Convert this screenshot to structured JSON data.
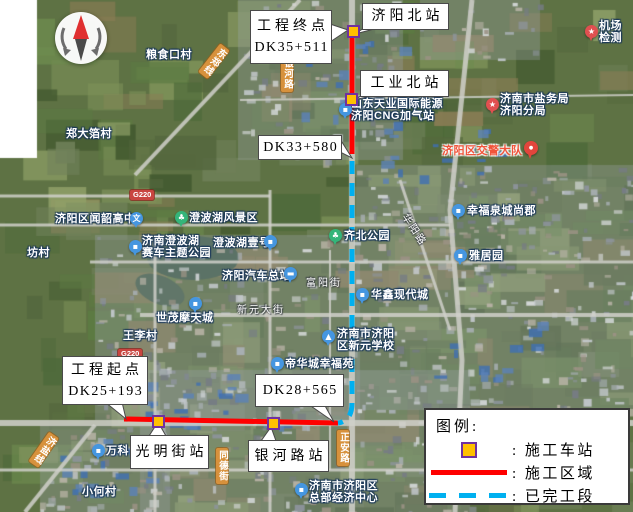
{
  "legend": {
    "title": "图例:",
    "items": [
      {
        "swatch": "station",
        "label": ": 施工车站"
      },
      {
        "swatch": "solid",
        "label": ": 施工区域"
      },
      {
        "swatch": "dashed",
        "label": ": 已完工段"
      }
    ],
    "colors": {
      "station_fill": "#FFC000",
      "station_border": "#7030A0",
      "solid": "#FF0000",
      "dashed": "#00B0F0"
    }
  },
  "route": {
    "solid_color": "#FF0000",
    "dashed_color": "#00B0F0",
    "solid_paths": [
      "M352 26 L352 154",
      "M124 419 L338 423"
    ],
    "dashed_paths": [
      "M352 161 L352 403 Q352 421 338 423"
    ]
  },
  "stations": [
    {
      "name": "station-marker-jiyang-north",
      "x": 353,
      "y": 31
    },
    {
      "name": "station-marker-gongye-north",
      "x": 351,
      "y": 99
    },
    {
      "name": "station-marker-guangming-street",
      "x": 158,
      "y": 421
    },
    {
      "name": "station-marker-yinhe-road",
      "x": 273,
      "y": 423
    }
  ],
  "callouts": [
    {
      "name": "callout-project-end",
      "lines": [
        "工程终点",
        "DK35+511"
      ],
      "box": [
        250,
        10,
        80,
        52
      ],
      "tri": [
        [
          330,
          24
        ],
        [
          330,
          42
        ],
        [
          348,
          30
        ]
      ]
    },
    {
      "name": "callout-jiyang-north-station",
      "lines": [
        "济阳北站"
      ],
      "box": [
        362,
        3,
        85,
        25
      ],
      "tri": [
        [
          364,
          28
        ],
        [
          378,
          28
        ],
        [
          355,
          34
        ]
      ]
    },
    {
      "name": "callout-gongye-north-station",
      "lines": [
        "工业北站"
      ],
      "box": [
        360,
        70,
        87,
        25
      ],
      "tri": [
        [
          363,
          95
        ],
        [
          377,
          95
        ],
        [
          353,
          100
        ]
      ]
    },
    {
      "name": "callout-dk33",
      "lines": [
        "DK33+580"
      ],
      "box": [
        258,
        135,
        82,
        23
      ],
      "tri": [
        [
          340,
          139
        ],
        [
          340,
          152
        ],
        [
          352,
          158
        ]
      ]
    },
    {
      "name": "callout-project-start",
      "lines": [
        "工程起点",
        "DK25+193"
      ],
      "box": [
        62,
        356,
        84,
        47
      ],
      "tri": [
        [
          105,
          402
        ],
        [
          122,
          402
        ],
        [
          126,
          419
        ]
      ]
    },
    {
      "name": "callout-dk28",
      "lines": [
        "DK28+565"
      ],
      "box": [
        255,
        374,
        87,
        31
      ],
      "tri": [
        [
          308,
          404
        ],
        [
          324,
          404
        ],
        [
          334,
          422
        ]
      ]
    },
    {
      "name": "callout-guangming-street-station",
      "lines": [
        "光明街站"
      ],
      "box": [
        130,
        435,
        77,
        32
      ],
      "tri": [
        [
          149,
          436
        ],
        [
          166,
          436
        ],
        [
          158,
          422
        ]
      ]
    },
    {
      "name": "callout-yinhe-road-station",
      "lines": [
        "银河路站"
      ],
      "box": [
        248,
        440,
        79,
        30
      ],
      "tri": [
        [
          261,
          441
        ],
        [
          276,
          441
        ],
        [
          271,
          427
        ]
      ]
    }
  ],
  "map_labels": [
    {
      "name": "poi-liangshikou-village",
      "text": "粮食口村",
      "x": 146,
      "y": 49
    },
    {
      "name": "poi-zhengdabo-village",
      "text": "郑大箔村",
      "x": 66,
      "y": 128
    },
    {
      "name": "poi-fang-village",
      "text": "坊村",
      "x": 27,
      "y": 247
    },
    {
      "name": "poi-cng-station",
      "lines": [
        "山东天业国际能源",
        "济阳CNG加气站"
      ],
      "x": 351,
      "y": 98,
      "icon": "building",
      "ix": 339,
      "iy": 103
    },
    {
      "name": "poi-airport-checkpoint",
      "lines": [
        "机场",
        "检测"
      ],
      "x": 599,
      "y": 20,
      "icon": "star",
      "ix": 585,
      "iy": 25
    },
    {
      "name": "poi-salt-bureau",
      "lines": [
        "济南市盐务局",
        "济阳分局"
      ],
      "x": 500,
      "y": 93,
      "icon": "star",
      "ix": 486,
      "iy": 98
    },
    {
      "name": "poi-traffic-police",
      "text": "济阳区交警大队",
      "x": 442,
      "y": 145,
      "cls": "red",
      "icon": "pin",
      "ix": 524,
      "iy": 141
    },
    {
      "name": "poi-wenshao-highschool",
      "text": "济阳区闻韶高中",
      "x": 55,
      "y": 213,
      "icon": "wen",
      "ix": 130,
      "iy": 212
    },
    {
      "name": "poi-chengbo-lake-scenic",
      "text": "澄波湖风景区",
      "x": 189,
      "y": 212,
      "icon": "park",
      "ix": 175,
      "iy": 211
    },
    {
      "name": "poi-racing-theme-park",
      "lines": [
        "济南澄波湖",
        "赛车主题公园"
      ],
      "x": 142,
      "y": 235,
      "icon": "building",
      "ix": 129,
      "iy": 240
    },
    {
      "name": "poi-chengbohu-yihao",
      "text": "澄波湖壹号",
      "x": 213,
      "y": 237,
      "icon": "building",
      "ix": 264,
      "iy": 235
    },
    {
      "name": "poi-jiyang-bus-terminal",
      "text": "济阳汽车总站",
      "x": 222,
      "y": 270,
      "icon": "bus",
      "ix": 284,
      "iy": 267
    },
    {
      "name": "poi-qibei-park",
      "text": "齐北公园",
      "x": 344,
      "y": 230,
      "icon": "park",
      "ix": 329,
      "iy": 229
    },
    {
      "name": "poi-xingfu-quancheng-shangjun",
      "text": "幸福泉城尚郡",
      "x": 467,
      "y": 205,
      "icon": "building",
      "ix": 452,
      "iy": 204
    },
    {
      "name": "poi-yajuyuan",
      "text": "雅居园",
      "x": 469,
      "y": 250,
      "icon": "building",
      "ix": 454,
      "iy": 249
    },
    {
      "name": "poi-huaxin-modern-city",
      "text": "华鑫现代城",
      "x": 371,
      "y": 289,
      "icon": "building",
      "ix": 356,
      "iy": 288
    },
    {
      "name": "poi-shimao-motian-city",
      "text": "世茂摩天城",
      "x": 156,
      "y": 312,
      "icon": "building",
      "ix": 189,
      "iy": 297
    },
    {
      "name": "poi-wangli-village",
      "text": "王李村",
      "x": 123,
      "y": 330
    },
    {
      "name": "poi-xinyuan-school",
      "lines": [
        "济南市济阳",
        "区新元学校"
      ],
      "x": 337,
      "y": 328,
      "icon": "school",
      "ix": 322,
      "iy": 330
    },
    {
      "name": "poi-dihua-xingfu-garden",
      "text": "帝华城幸福苑",
      "x": 285,
      "y": 358,
      "icon": "building",
      "ix": 271,
      "iy": 357
    },
    {
      "name": "poi-vanke",
      "text": "万科",
      "x": 106,
      "y": 445,
      "icon": "building",
      "ix": 92,
      "iy": 444
    },
    {
      "name": "poi-xiaohe-village",
      "text": "小何村",
      "x": 82,
      "y": 486
    },
    {
      "name": "poi-hq-economic-center",
      "lines": [
        "济南市济阳区",
        "总部经济中心"
      ],
      "x": 309,
      "y": 480,
      "icon": "building",
      "ix": 295,
      "iy": 483
    }
  ],
  "road_labels": [
    {
      "name": "road-xinyuan-street",
      "text": "新元大街",
      "x": 237,
      "y": 301
    },
    {
      "name": "road-fuyang-street",
      "text": "富阳街",
      "x": 306,
      "y": 274
    },
    {
      "name": "road-huayang-road",
      "text": "华阳路",
      "x": 412,
      "y": 210,
      "rotate": 57
    }
  ],
  "road_badges": [
    {
      "name": "badge-yinhe-road",
      "text": "银河路",
      "x": 281,
      "y": 56
    },
    {
      "name": "badge-dongzheng-line",
      "text": "东郑线",
      "x": 219,
      "y": 47,
      "rotate": 38
    },
    {
      "name": "badge-zhengan-road",
      "text": "正安路",
      "x": 337,
      "y": 430
    },
    {
      "name": "badge-tongde-street",
      "text": "同德街",
      "x": 216,
      "y": 448
    },
    {
      "name": "badge-jiyan-line",
      "text": "济盐线",
      "x": 48,
      "y": 435,
      "rotate": 35
    },
    {
      "name": "badge-g220-north",
      "text": "G220",
      "x": 130,
      "y": 190,
      "cls": "g"
    },
    {
      "name": "badge-g220-south",
      "text": "G220",
      "x": 118,
      "y": 349,
      "cls": "g"
    }
  ]
}
